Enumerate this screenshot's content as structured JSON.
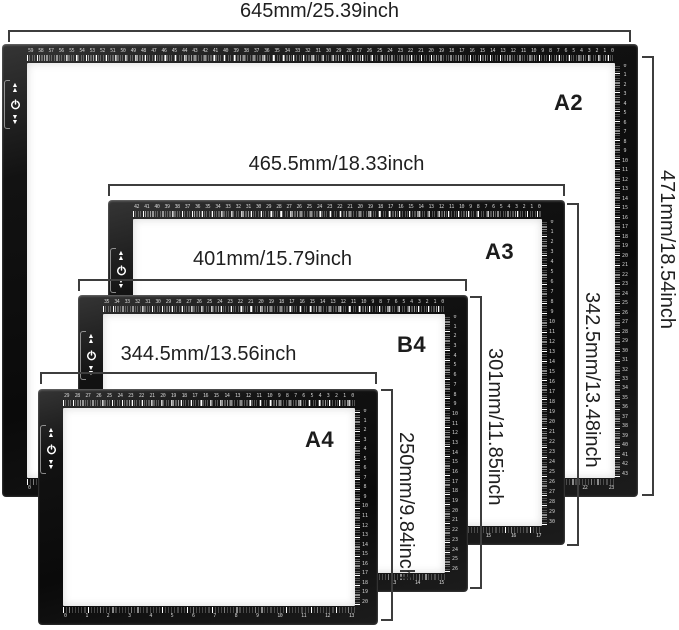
{
  "pads": [
    {
      "id": "a2",
      "label": "A2",
      "width_label": "645mm/25.39inch",
      "height_label": "471mm/18.54inch",
      "top_ruler": {
        "start": 59,
        "end": 0
      },
      "right_ruler": {
        "start": 0,
        "end": 43
      },
      "bottom_ruler": {
        "start": 0,
        "end": 23
      }
    },
    {
      "id": "a3",
      "label": "A3",
      "width_label": "465.5mm/18.33inch",
      "height_label": "342.5mm/13.48inch",
      "top_ruler": {
        "start": 42,
        "end": 0
      },
      "right_ruler": {
        "start": 0,
        "end": 30
      },
      "bottom_ruler": {
        "start": 0,
        "end": 17
      }
    },
    {
      "id": "b4",
      "label": "B4",
      "width_label": "401mm/15.79inch",
      "height_label": "301mm/11.85inch",
      "top_ruler": {
        "start": 35,
        "end": 0
      },
      "right_ruler": {
        "start": 0,
        "end": 26
      },
      "bottom_ruler": {
        "start": 0,
        "end": 15
      }
    },
    {
      "id": "a4",
      "label": "A4",
      "width_label": "344.5mm/13.56inch",
      "height_label": "250mm/9.84inch",
      "top_ruler": {
        "start": 29,
        "end": 0
      },
      "right_ruler": {
        "start": 0,
        "end": 20
      },
      "bottom_ruler": {
        "start": 0,
        "end": 13
      }
    }
  ],
  "icons": {
    "up": "brightness-up-icon",
    "power": "power-icon",
    "down": "brightness-down-icon"
  },
  "colors": {
    "frame": "#121212",
    "light_area": "#ffffff",
    "dimension_line": "#3d3d3d",
    "label_text": "#1f1f1f",
    "ruler_marks": "#ffffff"
  }
}
